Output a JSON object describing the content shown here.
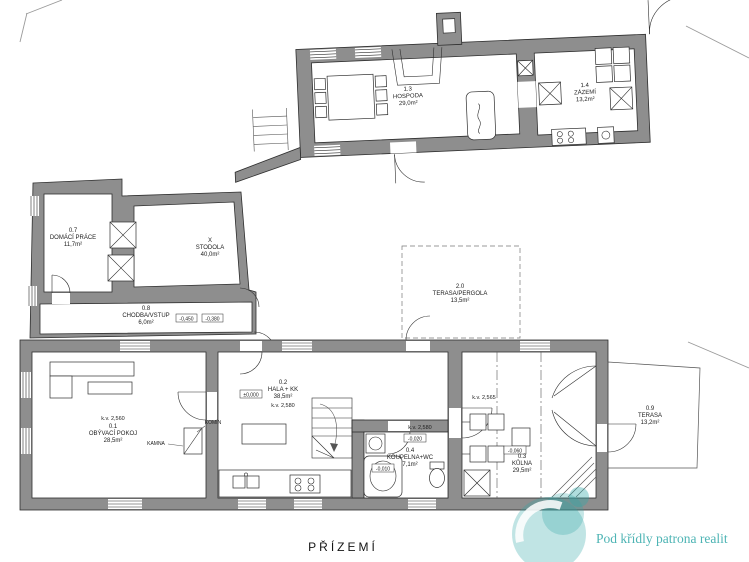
{
  "floor_title": "PŘÍZEMÍ",
  "watermark": {
    "text": "Pod křídly patrona realit",
    "color": "#2fa7a7"
  },
  "colors": {
    "wall": "#8e8e8e",
    "line": "#2e2e2e",
    "teal": "#2fa7a7"
  },
  "rooms": {
    "hospoda": {
      "id": "1.3",
      "name": "HOSPODA",
      "area": "29,0m²"
    },
    "zazemi": {
      "id": "1.4",
      "name": "ZÁZEMÍ",
      "area": "13,2m²"
    },
    "domaci_prace": {
      "id": "0.7",
      "name": "DOMÁCÍ PRÁCE",
      "area": "11,7m²"
    },
    "stodola": {
      "id": "X",
      "name": "STODOLA",
      "area": "40,0m²"
    },
    "chodba": {
      "id": "0.8",
      "name": "CHODBA/VSTUP",
      "area": "6,0m²",
      "levels": {
        "a": "-0,450",
        "b": "-0,380"
      }
    },
    "obyvaci_pokoj": {
      "id": "0.1",
      "name": "OBÝVACÍ POKOJ",
      "area": "28,5m²",
      "ceiling": "k.v. 2,560"
    },
    "hala": {
      "id": "0.2",
      "name": "HALA + KK",
      "area": "38,5m²",
      "ceiling": "k.v. 2,580",
      "level": "±0,000"
    },
    "koupelna": {
      "id": "0.4",
      "name": "KOUPELNA+WC",
      "area": "7,1m²",
      "ceiling": "k.v. 2,580",
      "levels": {
        "a": "-0,020",
        "b": "-0,010"
      }
    },
    "kulna": {
      "id": "0.3",
      "name": "KŮLNA",
      "area": "29,5m²",
      "ceiling": "k.v. 2,565",
      "level": "-0,060"
    },
    "terasa": {
      "id": "0.9",
      "name": "TERASA",
      "area": "13,2m²"
    },
    "pergola": {
      "id": "2.0",
      "name": "TERASA/PERGOLA",
      "area": "13,5m²"
    }
  },
  "annotations": {
    "komin": "KOMÍN",
    "kamna": "KAMNA"
  }
}
